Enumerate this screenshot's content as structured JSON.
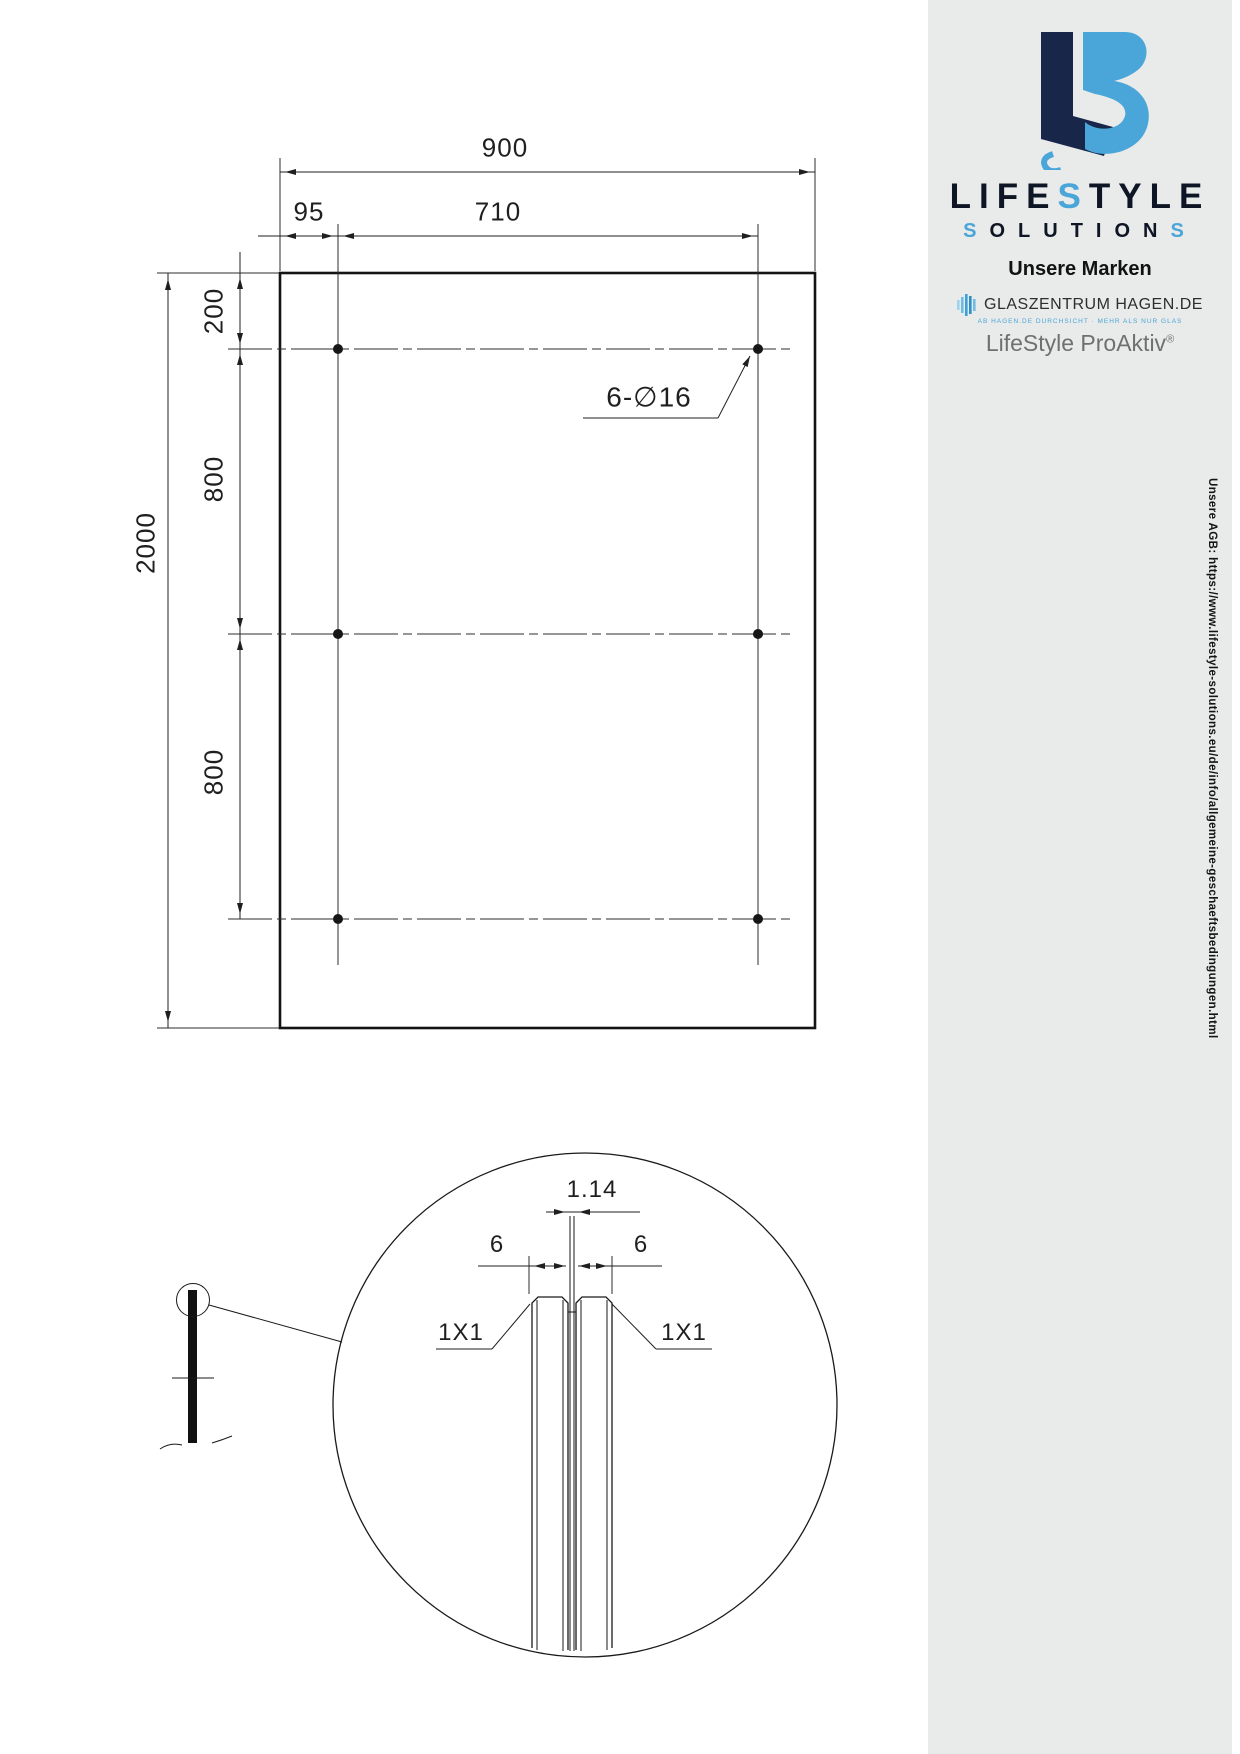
{
  "colors": {
    "accent_blue": "#4aa6d8",
    "navy": "#18264a",
    "link_blue": "#35a3dc",
    "text_gray": "#5b5b5b",
    "sidebar_bg": "#e9eaea"
  },
  "drawing": {
    "dim_width_total": "900",
    "dim_left_offset": "95",
    "dim_hole_span": "710",
    "dim_top_margin": "200",
    "dim_row_gap1": "800",
    "dim_row_gap2": "800",
    "dim_height_total": "2000",
    "holes_label": "6-∅16",
    "detail": {
      "gap_width": "1.14",
      "pane_left": "6",
      "pane_right": "6",
      "chamfer_left": "1X1",
      "chamfer_right": "1X1"
    }
  },
  "sidebar": {
    "logo": {
      "word1_pre": "LIFE",
      "word1_s": "S",
      "word1_post": "TYLE",
      "word2_s1": "S",
      "word2_mid": "OLUTION",
      "word2_s2": "S"
    },
    "brands_heading": "Unsere Marken",
    "brand1": {
      "name": "GLASZENTRUM HAGEN.DE",
      "tagline": "AB HAGEN.DE DURCHSICHT · MEHR ALS NUR GLAS"
    },
    "brand2": {
      "name": "LifeStyle ProAktiv",
      "reg": "®"
    },
    "agb_vertical": "Unsere AGB: https://www.lifestyle-solutions.eu/de/info/allgemeine-geschaeftsbedingungen.html",
    "company": {
      "name": "LifeStyle Solutions GmbH",
      "street": "Weidegang 8",
      "city": "58095 Hagen - GERMANY"
    },
    "contact": {
      "tel_label": "Tel.:",
      "tel": "+49 (0) 2331 923 40 30",
      "fax_label": "Fax:",
      "fax": "+49 (0) 2331 923 40 51",
      "email_label": "Email:",
      "email": "info@lifestyle-solutions.eu"
    },
    "registry": {
      "vat_label": "USt-IdNr.:",
      "vat": "DE270793383",
      "hrb_label": "HRB:",
      "hrb": "8465"
    },
    "links": {
      "site1": "www.lifestyle-solutions.eu",
      "site2": "www.glaszentrum-hagen.de"
    },
    "bank": {
      "iban_label": "IBAN:",
      "iban": "DE18 4507 0024 0666 5731 00",
      "bic_label": "BIC:",
      "bic": "DEUTDEDB450",
      "bank_label": "Bank:",
      "bank": "Deutsche Bank Hagen"
    },
    "ceo": {
      "label": "Geschäftsführer:",
      "name": "Kenan Genc"
    }
  }
}
